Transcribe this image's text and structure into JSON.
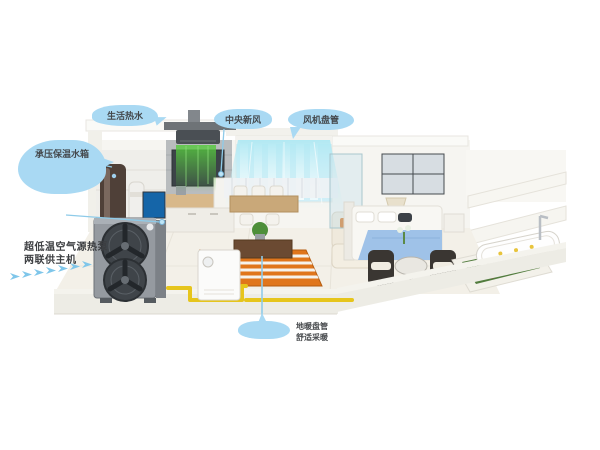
{
  "callouts": {
    "hot_water": "生活热水",
    "water_tank": "承压保温水箱",
    "fresh_air": "中央新风",
    "fan_coil": "风机盘管",
    "outdoor_unit": {
      "line1": "超低温空气源热泵",
      "line2": "两联供主机"
    },
    "floor_heating": {
      "line1": "地暖盘管",
      "line2": "舒适采暖"
    }
  },
  "colors": {
    "callout_blue": "#a9d9f3",
    "leader_blue": "#8ecbe9",
    "arrow_blue": "#7fc6ea",
    "beam_green": "#57c93f",
    "beam_cyan": "#aee8f3",
    "coil_orange": "#e0761c",
    "pipe_yellow": "#e6c51c",
    "label_text": "#3c3e41",
    "unit_gray": "#959aa0"
  }
}
